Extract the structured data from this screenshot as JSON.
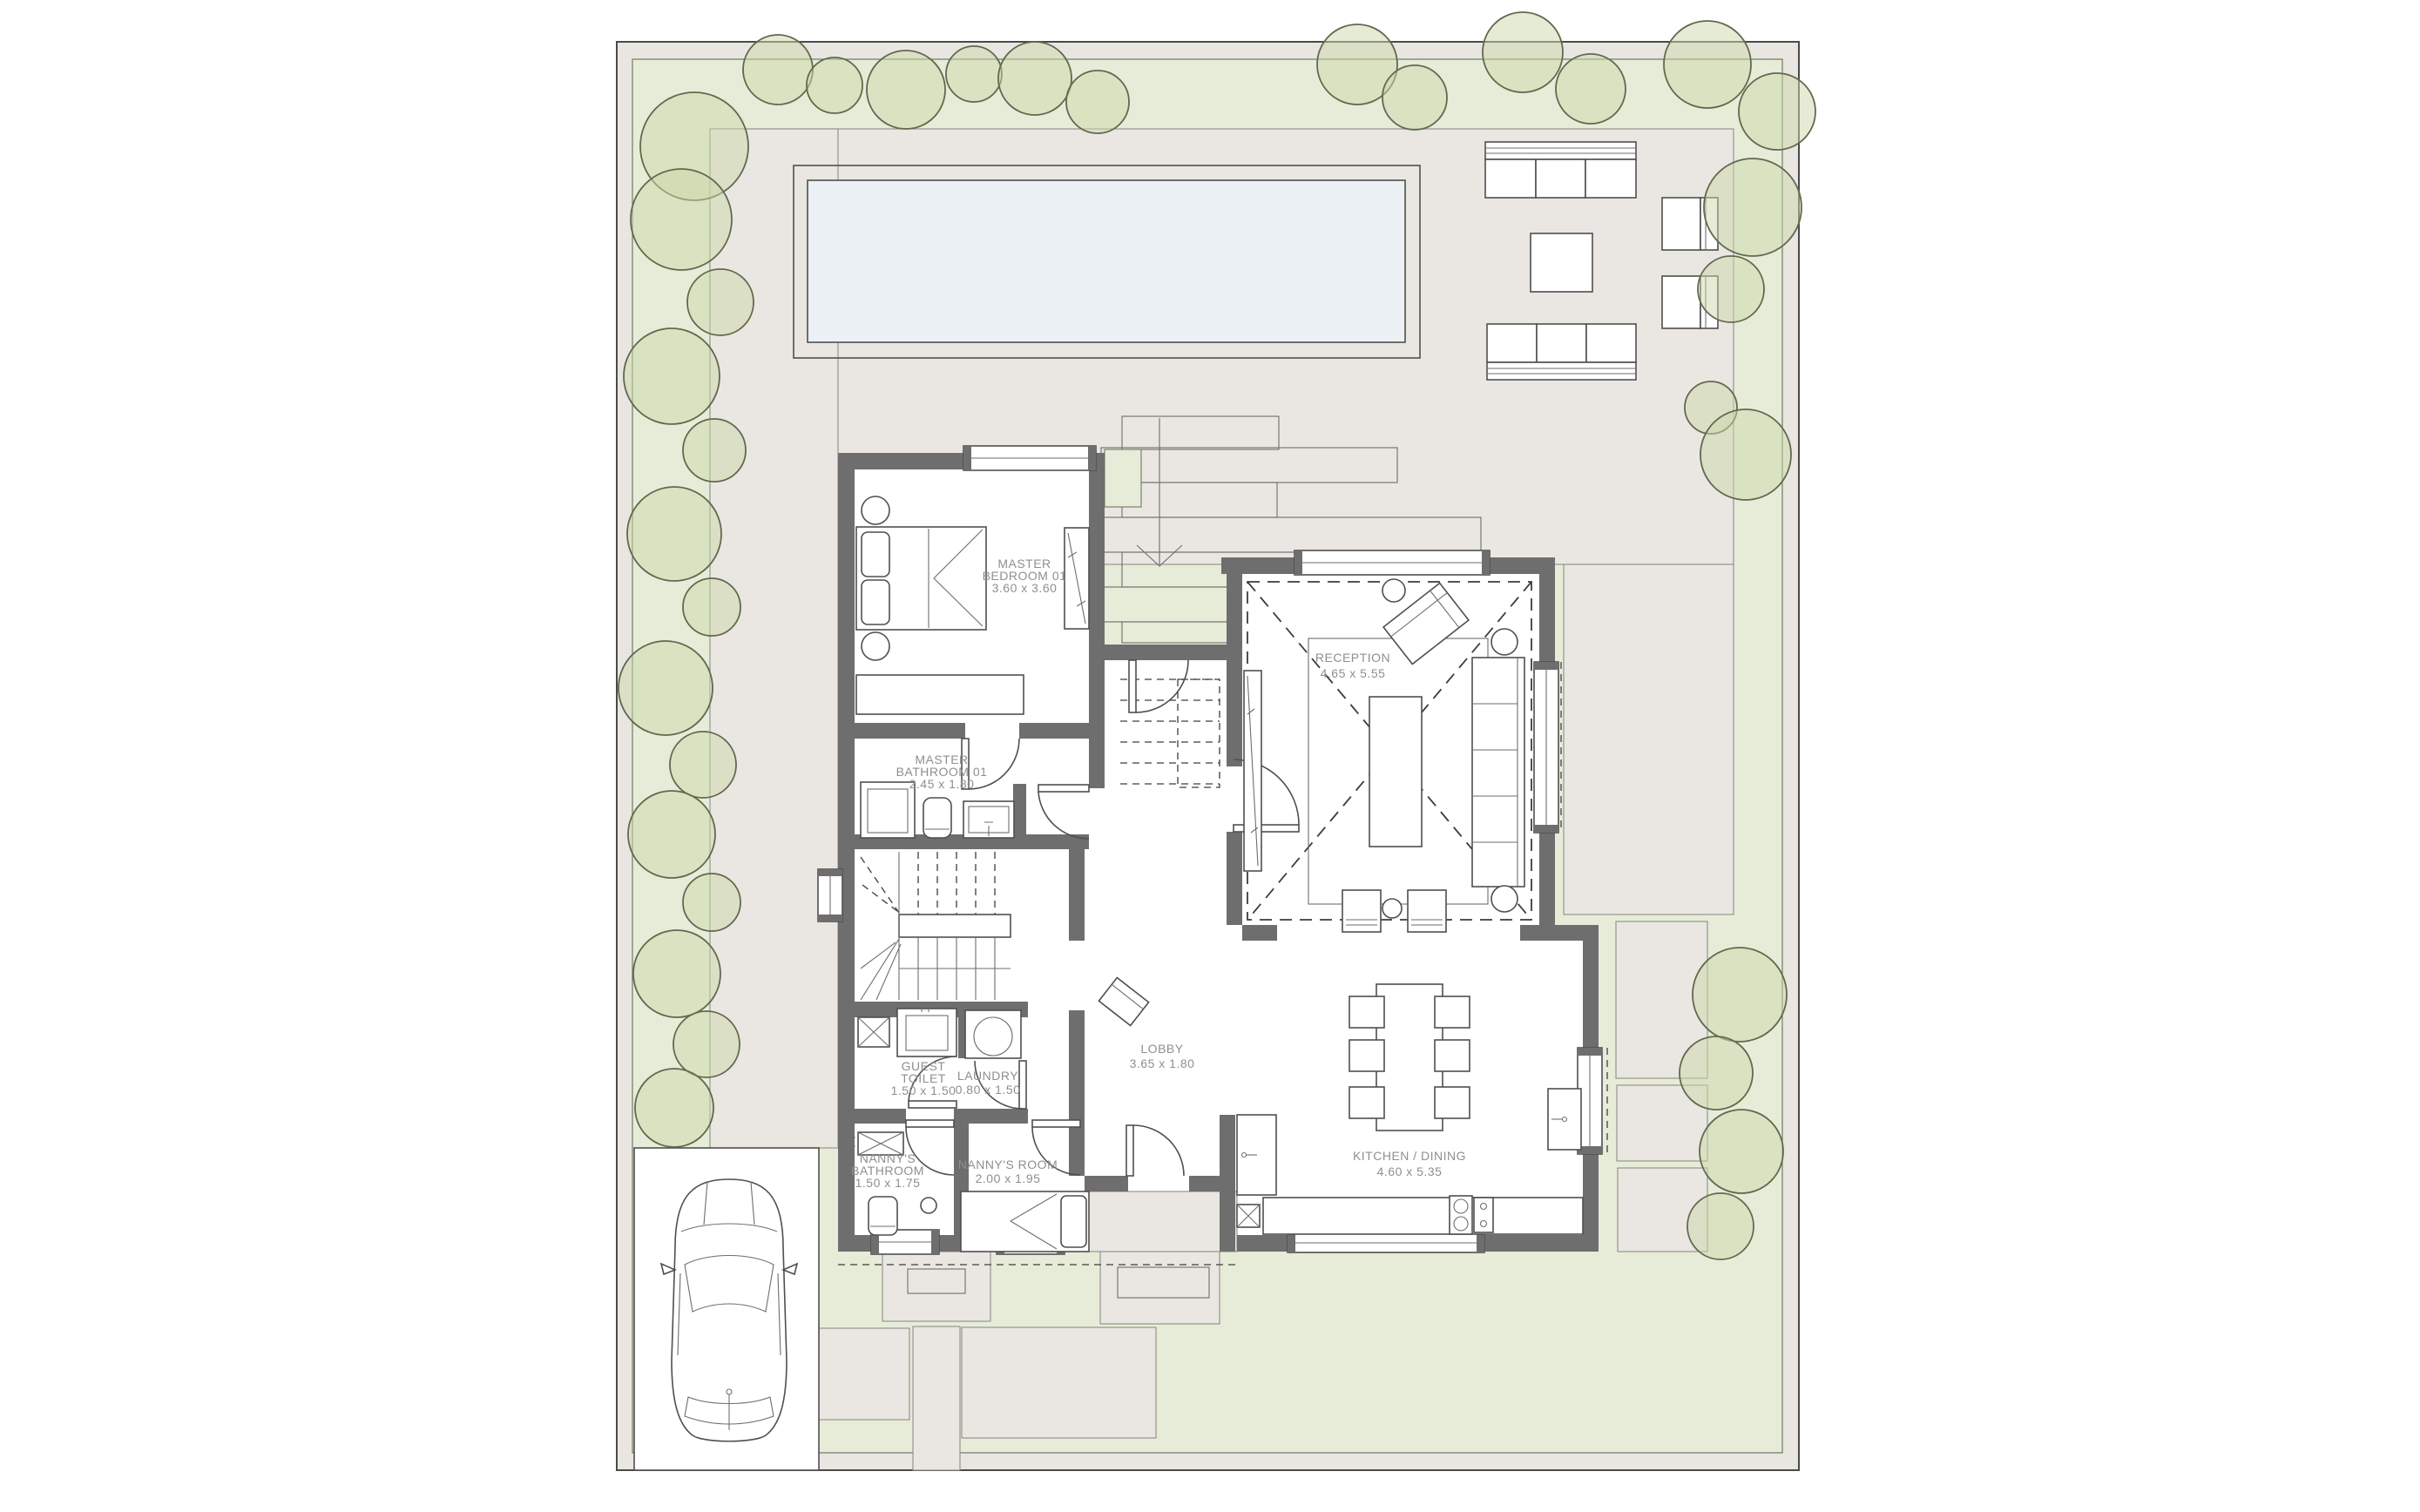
{
  "plan": {
    "type": "architectural-floor-plan",
    "rooms": [
      {
        "id": "master-bedroom-01",
        "lines": [
          "MASTER",
          "BEDROOM 01"
        ],
        "dims": "3.60 x 3.60"
      },
      {
        "id": "master-bathroom-01",
        "lines": [
          "MASTER",
          "BATHROOM 01"
        ],
        "dims": "2.45 x 1.80"
      },
      {
        "id": "reception",
        "lines": [
          "RECEPTION"
        ],
        "dims": "4.65 x 5.55"
      },
      {
        "id": "lobby",
        "lines": [
          "LOBBY"
        ],
        "dims": "3.65 x 1.80"
      },
      {
        "id": "kitchen-dining",
        "lines": [
          "KITCHEN / DINING"
        ],
        "dims": "4.60 x 5.35"
      },
      {
        "id": "guest-toilet",
        "lines": [
          "GUEST",
          "TOILET"
        ],
        "dims": "1.50 x 1.50"
      },
      {
        "id": "laundry",
        "lines": [
          "LAUNDRY"
        ],
        "dims": "0.80 x 1.50"
      },
      {
        "id": "nannys-bathroom",
        "lines": [
          "NANNY'S",
          "BATHROOM"
        ],
        "dims": "1.50 x 1.75"
      },
      {
        "id": "nannys-room",
        "lines": [
          "NANNY'S ROOM"
        ],
        "dims": "2.00 x 1.95"
      }
    ],
    "colors": {
      "site": "#e9e6e2",
      "lawn": "#e7ecd9",
      "terrace": "#eae7e3",
      "pool": "#ebf1f4",
      "wall": "#6e6e6e",
      "label": "#8f8f8f",
      "tree": "#ccd8aa",
      "parking": "#ffffff"
    }
  }
}
